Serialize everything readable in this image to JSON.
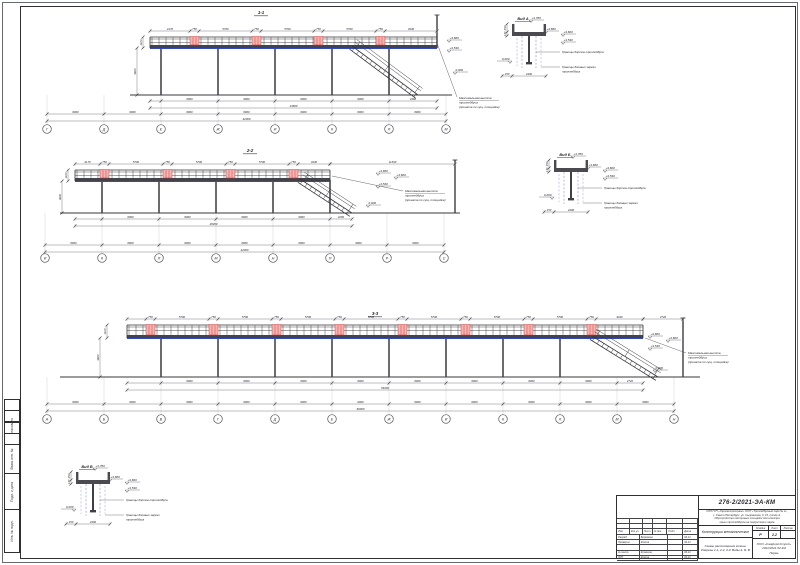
{
  "palette": {
    "line": "#35353a",
    "light_axis": "#c3c3ca",
    "dim_line": "#70707a",
    "text": "#26262b",
    "red_fill": "#f4b4b2",
    "red_stroke": "#cf3a36",
    "blue": "#3449c0",
    "blue_dash": "#8080cf",
    "steel": "#46464e"
  },
  "elevations": {
    "top": "+4,780",
    "e1": "+3,680",
    "e2": "+3,600",
    "e3": "+3,530",
    "zero": "0,000"
  },
  "common": {
    "max_height_note": [
      "Максимальная высота",
      "троллейбуса",
      "(принята по сущ. площадке)"
    ],
    "board_note": "Границы бортов троллейбуса",
    "mirror_note": [
      "Границы боковых зеркал",
      "троллейбуса"
    ]
  },
  "views": [
    {
      "name": "1-1",
      "title": "1-1",
      "title_pos": [
        261,
        14
      ],
      "deck": {
        "x0": 150,
        "x1": 437,
        "top": 37,
        "bot": 48
      },
      "panels": [
        190,
        252,
        314,
        376
      ],
      "columns": [
        161,
        218,
        275,
        332,
        389
      ],
      "stair": {
        "x0": 352,
        "x1": 418
      },
      "mast": {
        "x": 437,
        "y0": 15,
        "y1": 48
      },
      "ground": {
        "x0": 130,
        "x1": 452,
        "y": 95
      },
      "dims": [
        {
          "o": "h",
          "y": 31,
          "ticks": [
            150,
            190,
            199,
            252,
            261,
            314,
            323,
            376,
            385,
            437
          ],
          "labels": [
            "4170",
            "750",
            "5700",
            "750",
            "5700",
            "750",
            "5700",
            "750",
            "3440"
          ]
        },
        {
          "o": "h",
          "y": 101,
          "ticks": [
            150,
            161,
            218,
            275,
            332,
            389,
            437
          ],
          "labels": [
            "",
            "6000",
            "6000",
            "6000",
            "6000",
            "4360"
          ]
        },
        {
          "o": "h",
          "y": 108,
          "ticks": [
            150,
            437
          ],
          "labels": [
            "24600"
          ]
        },
        {
          "o": "h",
          "y": 114,
          "ticks": [
            47,
            104,
            161,
            218,
            275,
            332,
            389,
            446
          ],
          "labels": [
            "6000",
            "6000",
            "6000",
            "6000",
            "6000",
            "6000",
            "6000"
          ]
        },
        {
          "o": "h",
          "y": 121,
          "ticks": [
            47,
            446
          ],
          "labels": [
            "42000"
          ]
        },
        {
          "o": "v",
          "x": 137,
          "ticks": [
            48,
            95
          ],
          "labels": [
            "3600"
          ]
        },
        {
          "o": "v",
          "x": 143,
          "ticks": [
            37,
            48
          ],
          "labels": [
            "1100"
          ]
        }
      ],
      "bubbles": {
        "y": 129,
        "xs": [
          47,
          104,
          161,
          218,
          275,
          332,
          389,
          446
        ],
        "labels": [
          "Г",
          "Д",
          "Е",
          "Ж",
          "И",
          "К",
          "Л",
          "М"
        ]
      },
      "elev": [
        {
          "x": 449,
          "y": 40,
          "t": "e1"
        },
        {
          "x": 449,
          "y": 50,
          "t": "e3"
        },
        {
          "x": 455,
          "y": 72,
          "t": "zero"
        }
      ],
      "note_pos": [
        459,
        99
      ],
      "leader": [
        [
          437,
          43
        ],
        [
          457,
          97
        ]
      ]
    },
    {
      "name": "2-2",
      "title": "2-2",
      "title_pos": [
        250,
        152
      ],
      "deck": {
        "x0": 75,
        "x1": 330,
        "top": 170,
        "bot": 181
      },
      "panels": [
        100,
        163,
        226,
        289
      ],
      "columns": [
        102,
        159,
        216,
        273,
        330
      ],
      "stair": {
        "x0": 300,
        "x1": 352
      },
      "mast": {
        "x": 455,
        "y0": 160,
        "y1": 213
      },
      "ground": {
        "x0": 60,
        "x1": 460,
        "y": 213
      },
      "dims": [
        {
          "o": "h",
          "y": 164,
          "ticks": [
            75,
            100,
            109,
            163,
            172,
            226,
            235,
            289,
            298,
            330
          ],
          "labels": [
            "4170",
            "750",
            "5700",
            "750",
            "5700",
            "750",
            "5700",
            "750",
            "3440"
          ]
        },
        {
          "o": "h",
          "y": 164,
          "ticks": [
            330,
            455
          ],
          "labels": [
            "11540"
          ]
        },
        {
          "o": "h",
          "y": 219,
          "ticks": [
            75,
            102,
            159,
            216,
            273,
            330,
            352
          ],
          "labels": [
            "",
            "6000",
            "6000",
            "6000",
            "6000",
            "2260"
          ]
        },
        {
          "o": "h",
          "y": 226,
          "ticks": [
            75,
            352
          ],
          "labels": [
            "28260"
          ]
        },
        {
          "o": "h",
          "y": 245,
          "ticks": [
            45,
            102,
            159,
            216,
            273,
            330,
            387,
            444
          ],
          "labels": [
            "6000",
            "6000",
            "6000",
            "6000",
            "6000",
            "6000",
            "6000"
          ]
        },
        {
          "o": "h",
          "y": 252,
          "ticks": [
            45,
            444
          ],
          "labels": [
            "42000"
          ]
        },
        {
          "o": "v",
          "x": 62,
          "ticks": [
            181,
            213
          ],
          "labels": [
            "3600"
          ]
        },
        {
          "o": "v",
          "x": 68,
          "ticks": [
            170,
            181
          ],
          "labels": [
            "1100"
          ]
        }
      ],
      "bubbles": {
        "y": 258,
        "xs": [
          45,
          102,
          159,
          216,
          273,
          330,
          387,
          444
        ],
        "labels": [
          "И",
          "К",
          "Л",
          "М",
          "Н",
          "П",
          "Р",
          "С"
        ]
      },
      "elev": [
        {
          "x": 378,
          "y": 173,
          "t": "e1"
        },
        {
          "x": 396,
          "y": 177,
          "t": "e2"
        },
        {
          "x": 378,
          "y": 186,
          "t": "e3"
        },
        {
          "x": 368,
          "y": 205,
          "t": "zero"
        }
      ],
      "note_pos": [
        405,
        192
      ],
      "leader": [
        [
          332,
          176
        ],
        [
          403,
          191
        ]
      ]
    },
    {
      "name": "3-3",
      "title": "3-3",
      "title_pos": [
        375,
        315
      ],
      "deck": {
        "x0": 127,
        "x1": 643,
        "top": 325,
        "bot": 338
      },
      "panels": [
        146,
        209,
        272,
        335,
        398,
        461,
        524,
        587
      ],
      "columns": [
        161,
        218,
        275,
        332,
        389,
        446,
        503,
        560
      ],
      "stair": {
        "x0": 592,
        "x1": 658
      },
      "mast": {
        "x": 683,
        "y0": 318,
        "y1": 377
      },
      "ground": {
        "x0": 60,
        "x1": 700,
        "y": 377
      },
      "dims": [
        {
          "o": "h",
          "y": 319,
          "ticks": [
            127,
            146,
            155,
            209,
            218,
            272,
            281,
            335,
            344,
            398,
            407,
            461,
            470,
            524,
            533,
            587,
            596,
            643
          ],
          "labels": [
            "",
            "750",
            "5700",
            "750",
            "5700",
            "750",
            "5700",
            "750",
            "5700",
            "750",
            "5700",
            "750",
            "5700",
            "750",
            "5700",
            "750",
            "3440"
          ]
        },
        {
          "o": "h",
          "y": 319,
          "ticks": [
            643,
            683
          ],
          "labels": [
            "2720"
          ]
        },
        {
          "o": "h",
          "y": 383,
          "ticks": [
            127,
            161,
            218,
            275,
            332,
            389,
            446,
            503,
            560,
            617,
            643
          ],
          "labels": [
            "",
            "6000",
            "6000",
            "6000",
            "6000",
            "6000",
            "6000",
            "6000",
            "6000",
            "2720"
          ]
        },
        {
          "o": "h",
          "y": 390,
          "ticks": [
            127,
            643
          ],
          "labels": [
            "54000"
          ]
        },
        {
          "o": "h",
          "y": 404,
          "ticks": [
            47,
            104,
            161,
            218,
            275,
            332,
            389,
            446,
            503,
            560,
            617,
            674
          ],
          "labels": [
            "6000",
            "6000",
            "6000",
            "6000",
            "6000",
            "6000",
            "6000",
            "6000",
            "6000",
            "6000",
            "6000"
          ]
        },
        {
          "o": "h",
          "y": 411,
          "ticks": [
            47,
            674
          ],
          "labels": [
            "66000"
          ]
        },
        {
          "o": "v",
          "x": 100,
          "ticks": [
            338,
            377
          ],
          "labels": [
            "3600"
          ]
        },
        {
          "o": "v",
          "x": 107,
          "ticks": [
            325,
            338
          ],
          "labels": [
            "1100"
          ]
        }
      ],
      "bubbles": {
        "y": 419,
        "xs": [
          47,
          104,
          161,
          218,
          275,
          332,
          389,
          446,
          503,
          560,
          617,
          674
        ],
        "labels": [
          "А",
          "Б",
          "В",
          "Г",
          "Д",
          "Е",
          "Ж",
          "И",
          "К",
          "Л",
          "М",
          "Н"
        ]
      },
      "elev": [
        {
          "x": 650,
          "y": 336,
          "t": "e1"
        },
        {
          "x": 668,
          "y": 340,
          "t": "e2"
        },
        {
          "x": 650,
          "y": 348,
          "t": "e3"
        },
        {
          "x": 655,
          "y": 370,
          "t": "zero"
        }
      ],
      "note_pos": [
        688,
        354
      ],
      "leader": [
        [
          645,
          338
        ],
        [
          686,
          353
        ]
      ]
    }
  ],
  "details": [
    {
      "name": "vid-a",
      "title": "Вид А",
      "origin": [
        512,
        16
      ]
    },
    {
      "name": "vid-b",
      "title": "Вид Б",
      "origin": [
        554,
        152
      ]
    },
    {
      "name": "vid-v",
      "title": "Вид В",
      "origin": [
        76,
        464
      ]
    }
  ],
  "detail_dims": {
    "bottom": "2400",
    "left": [
      "250",
      "170"
    ],
    "side": "150"
  },
  "titleblock": {
    "doc_number": "276-2/2021-ЭА-КМ",
    "object_lines": [
      "СПб ГУП «Горэлектротранс» ОСП «Троллейбусный парк № 2»,",
      "г. Санкт-Петербург, ул. Сызранская, д. 15, литер А.",
      "Обустройство смотровых площадок для осмотра",
      "крыш троллейбусов на территории парка"
    ],
    "section_title": "Конструкции металлические",
    "sheet_title_lines": [
      "Схемы расположения колонн.",
      "Разрезы 1-1, 2-2, 3-3. Виды А, Б, В"
    ],
    "stage_label": "Стадия",
    "sheet_label": "Лист",
    "sheets_label": "Листов",
    "stage": "Р",
    "sheet_no": "2.2",
    "sheets_total": "",
    "company_lines": [
      "ООО «КомфортСтрой»",
      "2021/2021-52-4М",
      "Пермь"
    ],
    "sig_header": [
      "Изм.",
      "Кол.уч.",
      "Лист",
      "№ док.",
      "Подп.",
      "Дата"
    ],
    "sig_rows": [
      [
        "Разраб.",
        "Бережнов",
        "",
        "04.21"
      ],
      [
        "Проверил",
        "Козлов",
        "",
        "04.21"
      ],
      [
        "",
        "",
        "",
        ""
      ],
      [
        "Н.контр.",
        "Кузнецов",
        "",
        "04.21"
      ],
      [
        "ГИП",
        "Козлов",
        "",
        "04.21"
      ]
    ]
  },
  "side_strip": {
    "labels": [
      "",
      "",
      "Согласовано",
      "",
      "Взам. инв. №",
      "Подп. и дата",
      "Инв. № подл."
    ],
    "heights": [
      12,
      12,
      12,
      12,
      30,
      37,
      44
    ]
  }
}
